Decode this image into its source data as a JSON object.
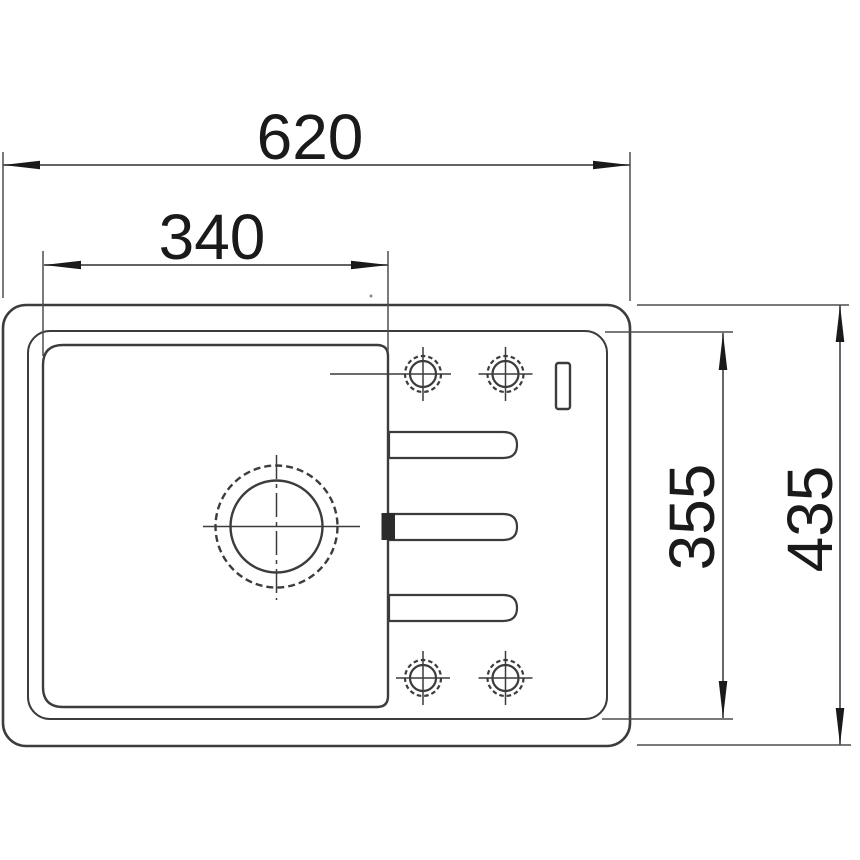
{
  "drawing": {
    "dimensions": {
      "overall_width": "620",
      "bowl_width": "340",
      "basin_depth": "355",
      "overall_depth": "435"
    },
    "colors": {
      "line": "#3c3c3c",
      "dimension": "#4d4d4d",
      "text": "#1a1a1a",
      "marker_fill": "#2b2b2b",
      "background": "#ffffff"
    }
  }
}
